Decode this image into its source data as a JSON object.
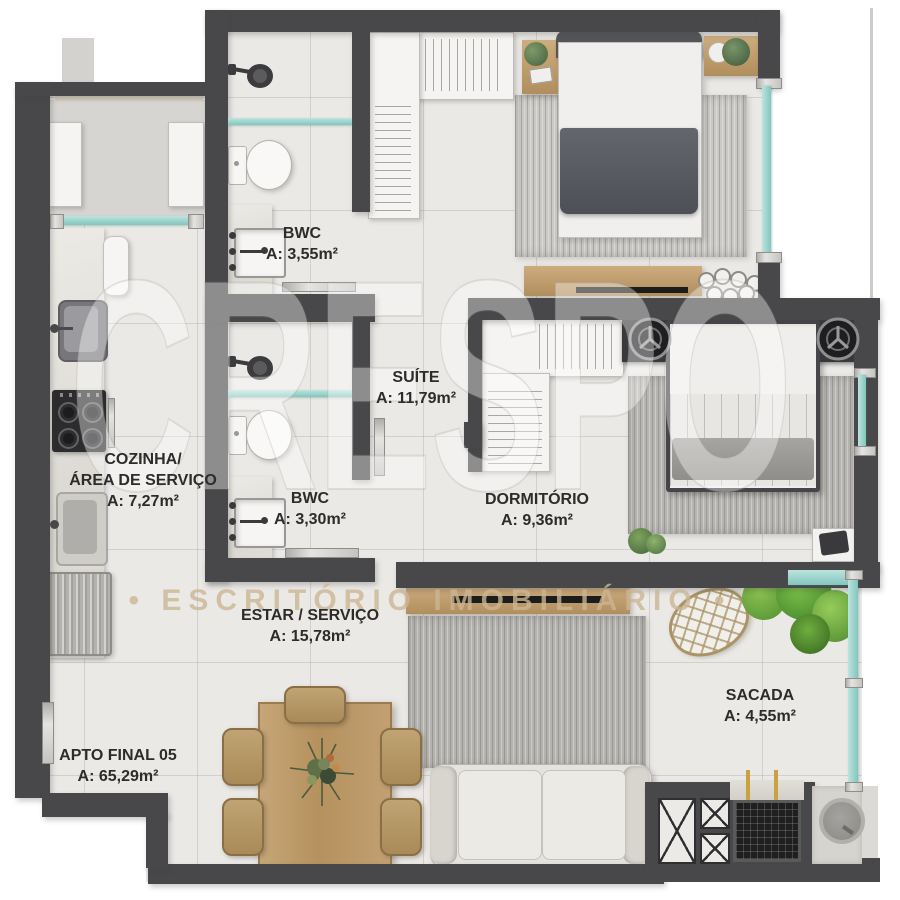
{
  "apartment": {
    "name": "APTO FINAL 05",
    "area": "A: 65,29m²"
  },
  "rooms": {
    "bwc_top": {
      "name": "BWC",
      "area": "A: 3,55m²"
    },
    "suite": {
      "name": "SUÍTE",
      "area": "A: 11,79m²"
    },
    "bwc_bottom": {
      "name": "BWC",
      "area": "A: 3,30m²"
    },
    "cozinha": {
      "line1": "COZINHA/",
      "line2": "ÁREA DE SERVIÇO",
      "area": "A: 7,27m²"
    },
    "dormitorio": {
      "name": "DORMITÓRIO",
      "area": "A: 9,36m²"
    },
    "estar": {
      "name": "ESTAR / SERVIÇO",
      "area": "A: 15,78m²"
    },
    "sacada": {
      "name": "SACADA",
      "area": "A: 4,55m²"
    }
  },
  "watermark": {
    "logo": "CRESPO",
    "subtitle": "• ESCRITÓRIO IMOBILIÁRIO •"
  },
  "colors": {
    "wall": "#48484a",
    "floor": "#ebe9e6",
    "glass": "#8fcec5",
    "wood": "#c0a175",
    "accent_text": "#2d2c2a"
  }
}
